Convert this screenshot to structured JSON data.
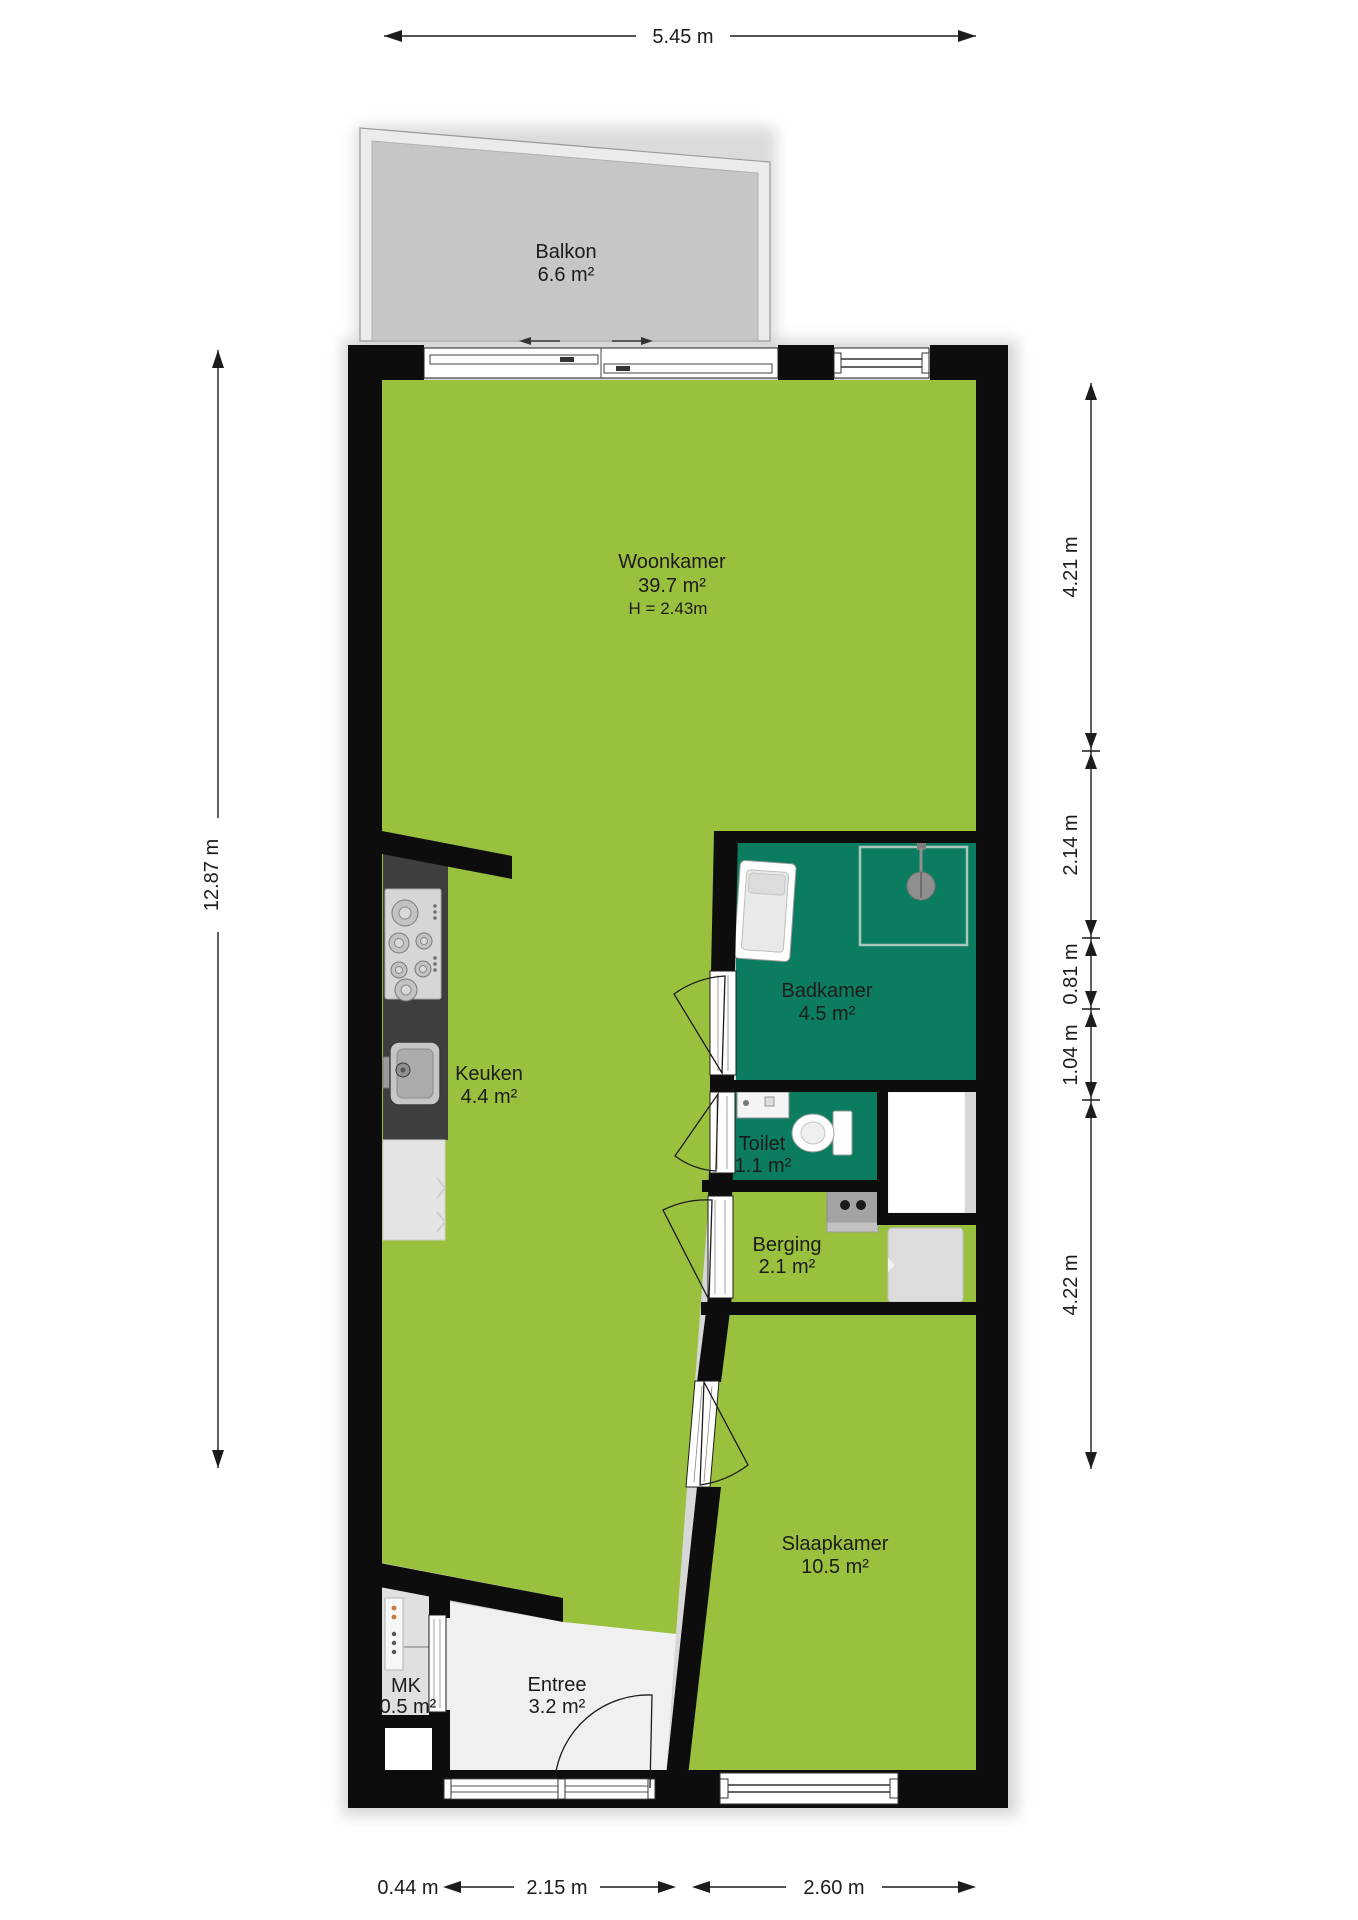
{
  "plan_type": "apartment-floorplan",
  "colors": {
    "floor_green": "#9ac13e",
    "wet_room_teal": "#0b7c5f",
    "wall_black": "#0d0d0d",
    "balcony_floor": "#c6c6c6",
    "balcony_railing": "#ebebeb",
    "entree_floor": "#f0f0f0",
    "mk_floor": "#e0e0e0",
    "kitchen_counter": "#3e3e3e"
  },
  "rooms": {
    "balkon": {
      "name": "Balkon",
      "area": "6.6 m²"
    },
    "woonkamer": {
      "name": "Woonkamer",
      "area": "39.7 m²",
      "ceiling_height": "H = 2.43m"
    },
    "keuken": {
      "name": "Keuken",
      "area": "4.4 m²"
    },
    "badkamer": {
      "name": "Badkamer",
      "area": "4.5 m²"
    },
    "toilet": {
      "name": "Toilet",
      "area": "1.1 m²"
    },
    "berging": {
      "name": "Berging",
      "area": "2.1 m²"
    },
    "slaapkamer": {
      "name": "Slaapkamer",
      "area": "10.5 m²"
    },
    "entree": {
      "name": "Entree",
      "area": "3.2 m²"
    },
    "mk": {
      "name": "MK",
      "area": "0.5 m²"
    }
  },
  "dimensions": {
    "top_width": "5.45 m",
    "left_height": "12.87 m",
    "right": [
      "4.21 m",
      "2.14 m",
      "0.81 m",
      "1.04 m",
      "4.22 m"
    ],
    "bottom": [
      "0.44 m",
      "2.15 m",
      "2.60 m"
    ]
  },
  "fixtures": [
    "stove-icon",
    "sink-icon",
    "tall-cabinet-icon",
    "bathtub-icon",
    "shower-head-icon",
    "washbasin-icon",
    "toilet-bowl-icon",
    "boiler-icon",
    "washing-machine-icon",
    "electrical-panel-icon",
    "door-swing-icon",
    "sliding-door-icon",
    "window-icon"
  ]
}
